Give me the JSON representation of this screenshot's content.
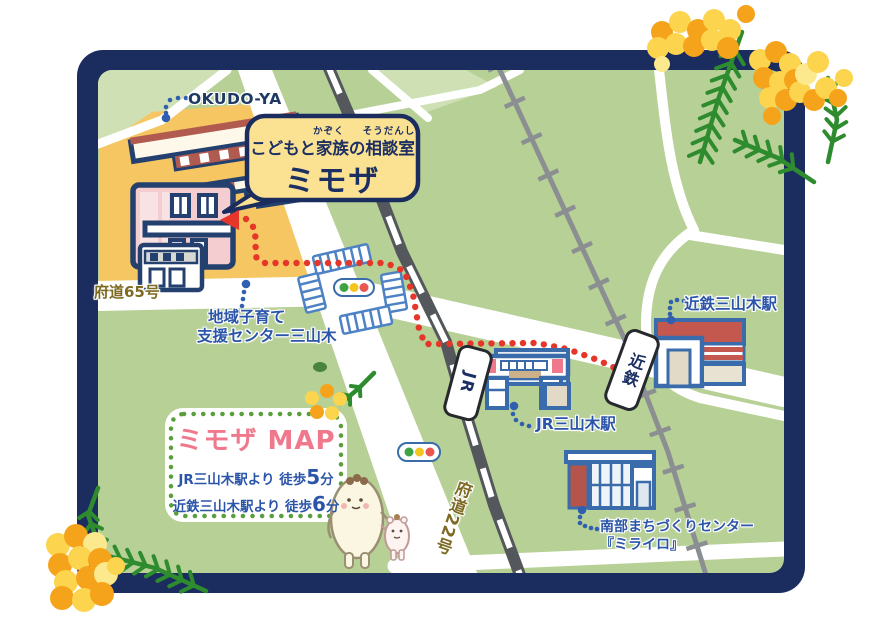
{
  "labels": {
    "okudoya": "OKUDO-YA",
    "fudo65": "府道65号",
    "fudo22": "府道22号",
    "chiiki_line1": "地域子育て",
    "chiiki_line2": "支援センター三山木",
    "jr_station": "JR三山木駅",
    "kintetsu_station": "近鉄三山木駅",
    "nanbu_line1": "南部まちづくりセンター",
    "nanbu_line2": "『ミライロ』"
  },
  "badges": {
    "jr": "JR",
    "kintetsu": "近鉄"
  },
  "callout": {
    "furigana_left": "かぞく",
    "furigana_right": "そうだんしつ",
    "subtitle": "こどもと家族の相談室",
    "title": "ミモザ"
  },
  "map_box": {
    "title": "ミモザ MAP",
    "route1_prefix": "JR三山木駅より 徒歩",
    "route1_minutes": "5",
    "route1_unit": "分",
    "route2_prefix": "近鉄三山木駅より 徒歩",
    "route2_minutes": "6",
    "route2_unit": "分"
  },
  "colors": {
    "frame_navy": "#1b2c5e",
    "map_green": "#b7d096",
    "light_block_green": "#cfe0b4",
    "yellow_block": "#f5c661",
    "route_red": "#e63529",
    "label_blue": "#2b55a8",
    "road_label_olive": "#7d6a23",
    "callout_yellow": "#fbe293",
    "map_title_pink": "#f0788c",
    "traffic_light_lights": [
      "#3fa344",
      "#f3c51f",
      "#e8564f"
    ],
    "mimosa_flower_palette": [
      "#f6a31c",
      "#fcd44e",
      "#fde98d"
    ]
  }
}
